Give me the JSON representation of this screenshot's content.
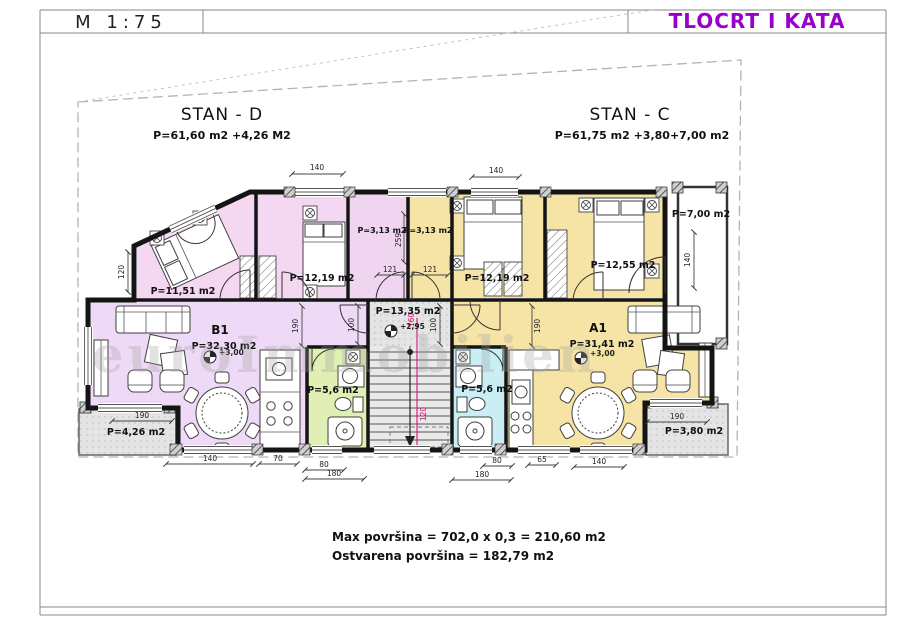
{
  "header": {
    "scale": "M 1:75",
    "title": "TLOCRT  I KATA"
  },
  "stan_d": {
    "name": "STAN - D",
    "area": "P=61,60 m2 +4,26 M2"
  },
  "stan_c": {
    "name": "STAN - C",
    "area": "P=61,75 m2 +3,80+7,00 m2"
  },
  "rooms": {
    "bedroom_d1": "P=11,51 m2",
    "bedroom_d2": "P=12,19 m2",
    "hall_d": "P=3,13 m2",
    "hall_c": "P=3,13 m2",
    "bedroom_c1": "P=12,19 m2",
    "bedroom_c2": "P=12,55 m2",
    "terrace": "P=7,00 m2",
    "stairwell": "P=13,35 m2",
    "living_d_id": "B1",
    "living_d": "P=32,30 m2",
    "living_c_id": "A1",
    "living_c": "P=31,41 m2",
    "bath_d": "P=5,6 m2",
    "bath_c": "P=5,6 m2",
    "balcony_d": "P=4,26 m2",
    "balcony_c": "P=3,80 m2"
  },
  "levels": {
    "stairwell": "+2,95",
    "living_d": "+3,00",
    "living_c": "+3,00"
  },
  "dims": {
    "top_d": "140",
    "top_c": "140",
    "bottom_d_140": "140",
    "bottom_d_70": "70",
    "bottom_d_80": "80",
    "bottom_d_180": "180",
    "bottom_c_80": "80",
    "bottom_c_65": "65",
    "bottom_c_140": "140",
    "bottom_c_180": "180",
    "left_120": "120",
    "stair_left_100": "100",
    "stair_right_100": "100",
    "b1_190": "190",
    "a1_190": "190",
    "hall_d_121": "121",
    "hall_c_121": "121",
    "hall_259": "259",
    "terrace_140": "140",
    "balcony_d_190": "190",
    "balcony_c_190": "190",
    "stair_120": "120",
    "stair_160": "160"
  },
  "summary": {
    "line1": "Max površina = 702,0 x 0,3 = 210,60 m2",
    "line2": "Ostvarena  površina = 182,79 m2"
  },
  "watermark": "euroImmobilien",
  "colors": {
    "title_magenta": "#9900cc",
    "room_pink": "#f4d8f2",
    "room_lavender": "#eed9f6",
    "room_yellow": "#f5e4a6",
    "room_green": "#e0efb4",
    "room_cyan": "#c9eff4",
    "paving_gray": "#e3e3e3",
    "dim_magenta": "#d4006a"
  }
}
